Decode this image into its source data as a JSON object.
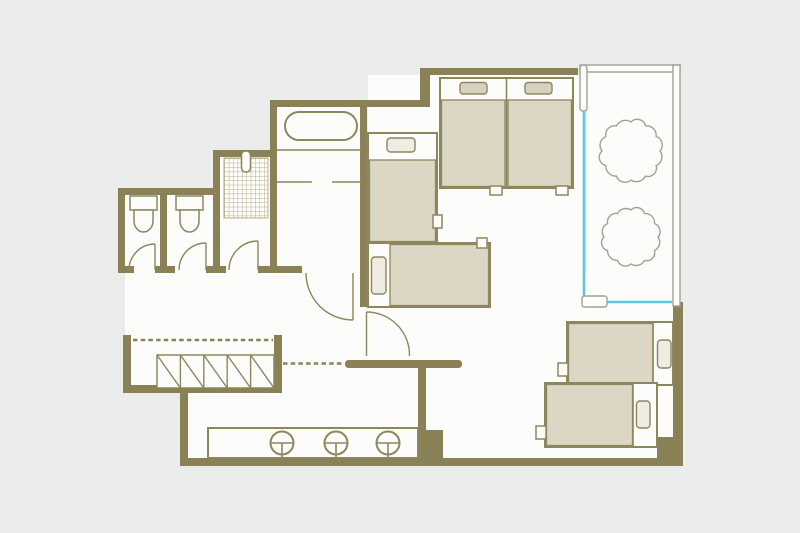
{
  "page": {
    "background_color": "#ebecec",
    "kind": "apartment floor plan drawing"
  },
  "colors": {
    "bg": "#ebecec",
    "wall": "#8a8256",
    "fixture": "#8e865c",
    "floor": "#fcfcfa",
    "bed": "#dcd7c5",
    "pillow": "#d7d2bf",
    "pillow-light": "#efede3",
    "glass": "#5ec9dc",
    "rail": "#a2a195",
    "grid": "#b6ae8d",
    "dash": "#8a8256"
  },
  "floorplan": {
    "type": "floor-plan",
    "rooms": [
      {
        "name": "toilet-stall-1",
        "fixtures": [
          "toilet",
          "swing-door"
        ]
      },
      {
        "name": "toilet-stall-2",
        "fixtures": [
          "toilet",
          "swing-door"
        ]
      },
      {
        "name": "shower-room",
        "fixtures": [
          "tiled-shower-floor",
          "shower-head",
          "swing-door"
        ]
      },
      {
        "name": "bathroom",
        "fixtures": [
          "bathtub",
          "glass-partition",
          "swing-door"
        ]
      },
      {
        "name": "main-bedroom",
        "fixtures": [
          "twin-bed-left",
          "twin-bed-right",
          "single-bed-vertical",
          "single-bed-horizontal",
          "swing-door"
        ]
      },
      {
        "name": "balcony",
        "fixtures": [
          "tree-upper",
          "tree-lower",
          "sliding-glass-window",
          "door-handle"
        ]
      },
      {
        "name": "second-bedroom",
        "fixtures": [
          "single-bed-upper",
          "single-bed-lower"
        ]
      },
      {
        "name": "hallway",
        "fixtures": [
          "staircase",
          "dashed-circulation-path"
        ]
      },
      {
        "name": "living-kitchen",
        "fixtures": [
          "counter-with-sinks"
        ]
      }
    ],
    "counts": {
      "beds": 6,
      "toilets": 2,
      "sinks": 3,
      "bathtubs": 1,
      "showers": 1,
      "staircases": 1,
      "trees": 2,
      "doors": 6
    }
  }
}
